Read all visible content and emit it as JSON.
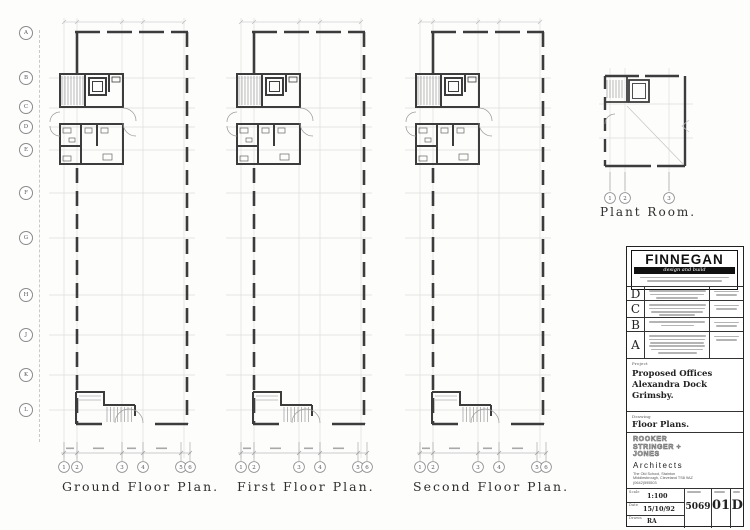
{
  "sheet": {
    "plans": {
      "ground_label": "Ground Floor Plan.",
      "first_label": "First Floor Plan.",
      "second_label": "Second Floor Plan.",
      "plant_label": "Plant Room."
    },
    "grid": {
      "rows": [
        "A",
        "B",
        "C",
        "D",
        "E",
        "F",
        "G",
        "H",
        "J",
        "K",
        "L"
      ],
      "cols": [
        "1",
        "2",
        "3",
        "4",
        "5",
        "6"
      ],
      "plant_cols": [
        "1",
        "2",
        "3"
      ]
    }
  },
  "title_block": {
    "contractor": {
      "name": "FINNEGAN",
      "tagline": "design and build"
    },
    "revisions": [
      {
        "letter": "D"
      },
      {
        "letter": "C"
      },
      {
        "letter": "B"
      },
      {
        "letter": "A"
      }
    ],
    "project": {
      "label": "Project",
      "line1": "Proposed Offices",
      "line2": "Alexandra Dock",
      "line3": "Grimsby."
    },
    "drawing": {
      "label": "Drawing",
      "title": "Floor Plans."
    },
    "architects": {
      "logo_line1": "ROOKER",
      "logo_line2": "STRINGER +",
      "logo_line3": "JONES",
      "name": "Architects",
      "address_line1": "The Old School, Stainton",
      "address_line2": "Middlesbrough, Cleveland TS8 9AZ",
      "address_line3": "(0642)595503"
    },
    "info": {
      "scale_label": "Scale",
      "scale_value": "1:100",
      "date_label": "Date",
      "date_value": "15/10/92",
      "drawn_label": "Drawn",
      "drawn_value": "RA",
      "job_number": "5069",
      "sheet_number": "01",
      "revision": "D"
    }
  }
}
